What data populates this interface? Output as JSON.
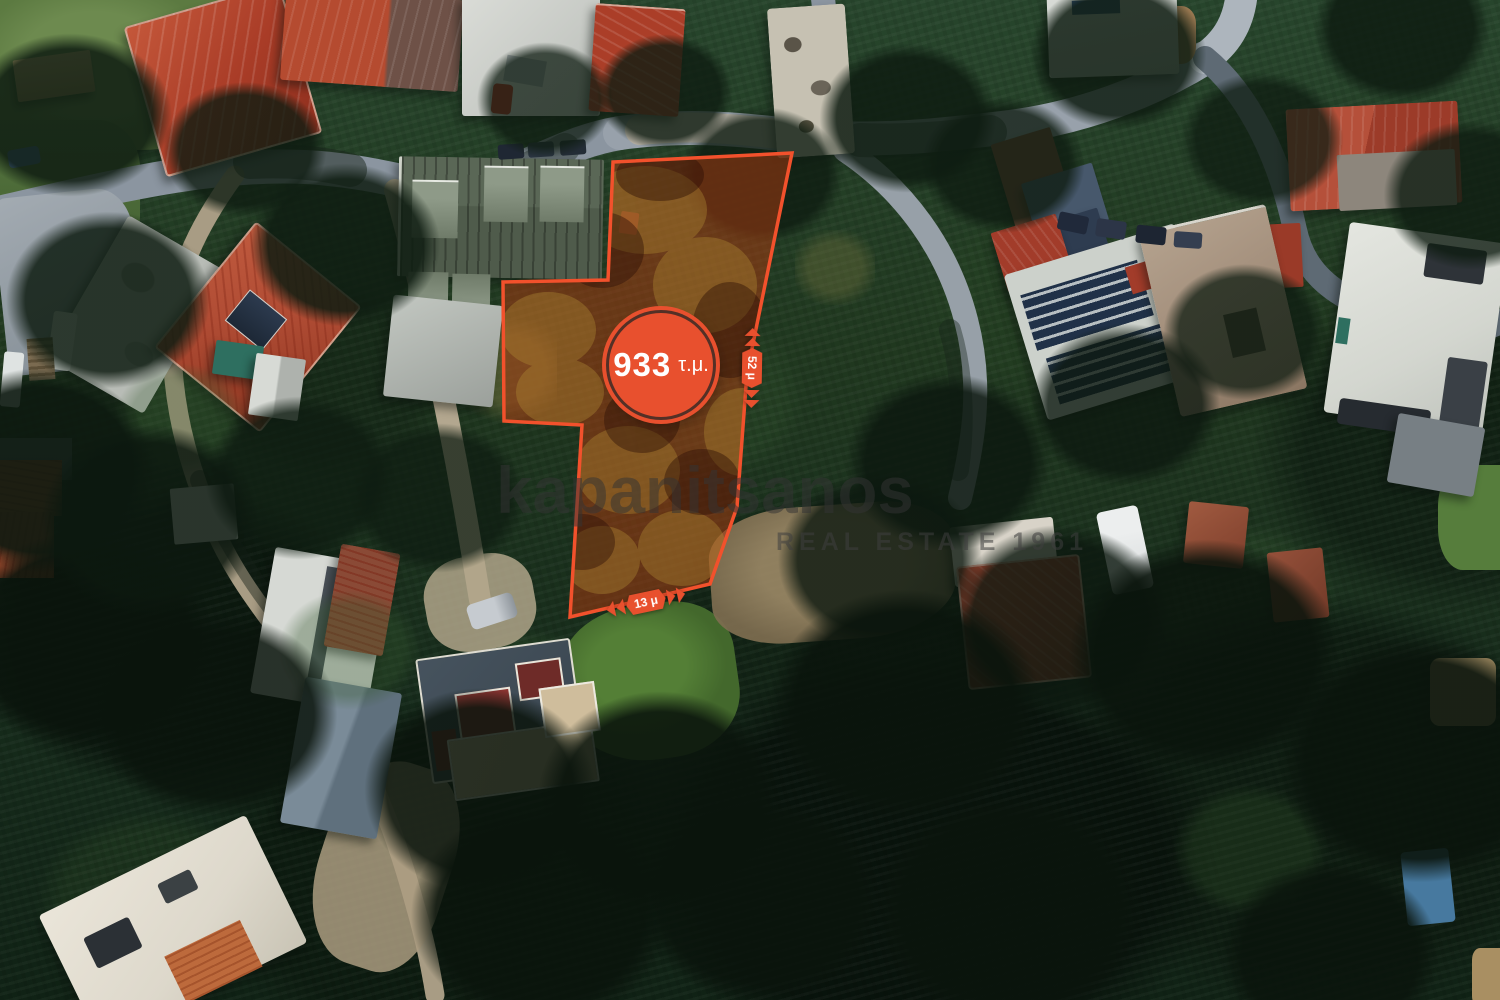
{
  "map": {
    "plot": {
      "path": "M 613 162 L 792 153 L 747 373 L 737 507 L 710 584 L 570 617 L 582 425 L 504 421 L 503 282 L 608 280 Z",
      "area_value": "933",
      "area_unit": "τ.μ.",
      "side_dimension": "52 μ",
      "front_dimension": "13 μ",
      "outline_color": "#f2512c",
      "badge_color": "#e8502e"
    },
    "watermark": {
      "brand": "kapanitsanos",
      "tagline": "REAL ESTATE 1961",
      "color": "#3c3c3c"
    }
  }
}
